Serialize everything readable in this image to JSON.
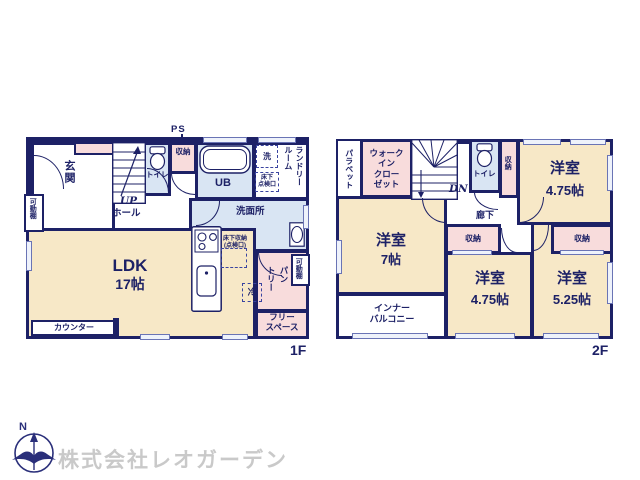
{
  "colors": {
    "wall": "#1d2166",
    "room_beige": "#f7e8c7",
    "closet_pink": "#f8dcdc",
    "wet_blue": "#d9e5f3",
    "watermark_gray": "#c9c9c9"
  },
  "watermark": "株式会社レオガーデン",
  "compass": {
    "north": "N"
  },
  "f1": {
    "floor_label": "1F",
    "ps": "PS",
    "genkan": "玄関",
    "movable_shelf_left": "可動棚",
    "stairs_dir": "UP",
    "hall": "ホール",
    "toilet": "トイレ",
    "closet": "収納",
    "bath": "UB",
    "laundry": "ランドリー\nルーム",
    "washer": "洗",
    "underfloor_hatch": "床下\n点検口",
    "washroom": "洗面所",
    "ldk": "LDK",
    "ldk_size": "17帖",
    "counter": "カウンター",
    "underfloor_storage": "床下収納\n(点検口)",
    "fridge": "冷",
    "pantry": "パン\nトリー",
    "movable_shelf_right": "可動棚",
    "free_space": "フリー\nスペース"
  },
  "f2": {
    "floor_label": "2F",
    "parapet": "パラペット",
    "wic": "ウォーク\nイン\nクロー\nゼット",
    "stairs_dir": "DN",
    "toilet": "トイレ",
    "closet_top": "収納",
    "room_a": "洋室",
    "room_a_size": "4.75帖",
    "hallway": "廊下",
    "closet_mid": "収納",
    "room_b": "洋室",
    "room_b_size": "7帖",
    "balcony": "インナー\nバルコニー",
    "room_c": "洋室",
    "room_c_size": "4.75帖",
    "room_d": "洋室",
    "room_d_size": "5.25帖",
    "closet_right": "収納"
  }
}
